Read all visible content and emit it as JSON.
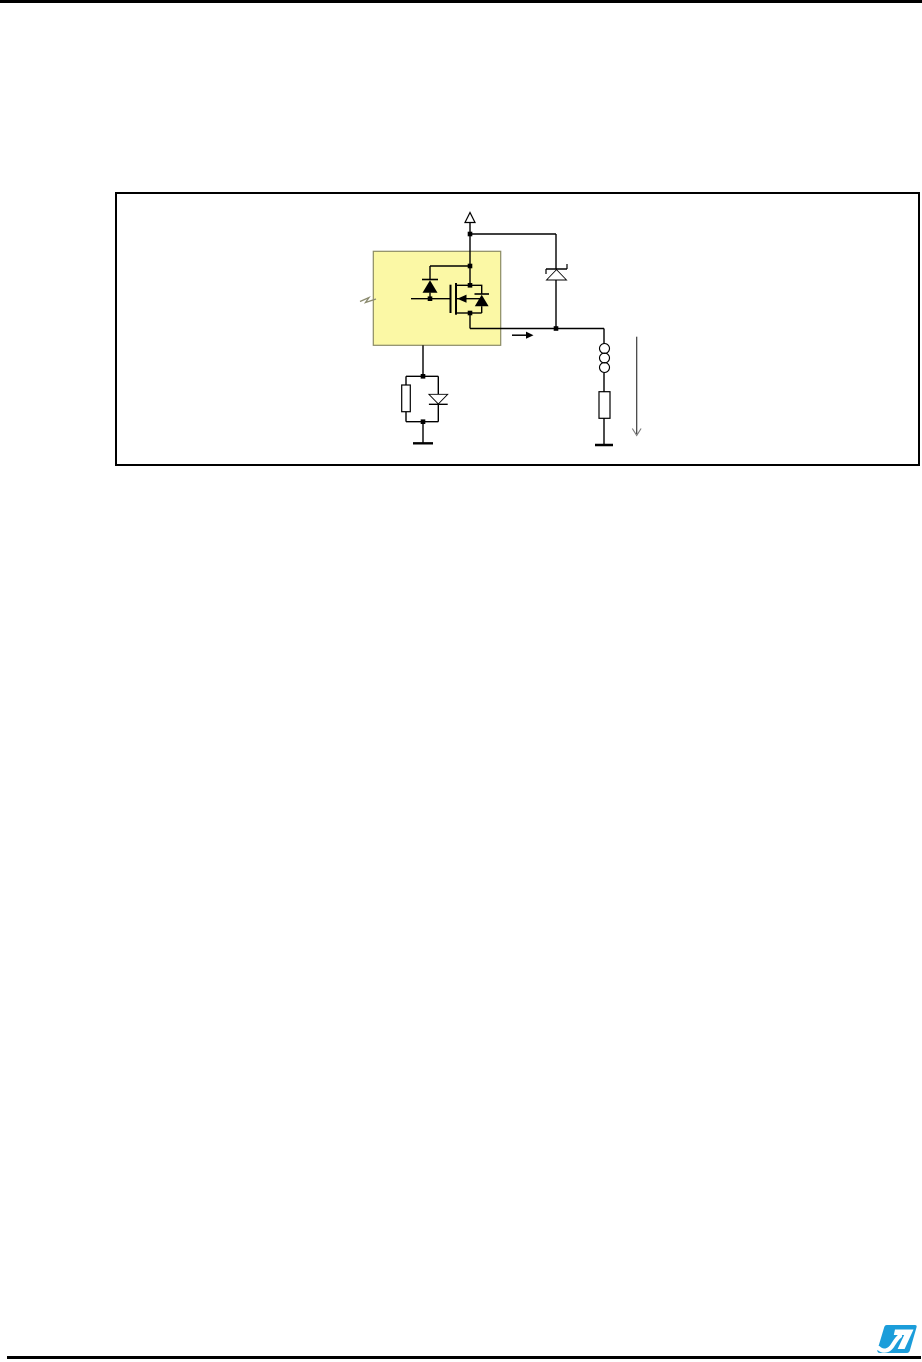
{
  "page": {
    "background_color": "#ffffff",
    "top_rule_color": "#000000",
    "bottom_rule_color": "#000000"
  },
  "figure": {
    "kind": "circuit-schematic",
    "frame_color": "#000000",
    "wire_color": "#000000",
    "highlight_block": {
      "fill": "#FBF8A5",
      "stroke": "#8B8B66"
    },
    "components": {
      "supply_arrow": "supply-rail-arrow",
      "clamp_zener": "zener-diode",
      "gate_diode": "gate-protection-diode",
      "mosfet": "n-channel-mosfet",
      "body_diode": "mosfet-body-diode",
      "input_break": "input-zigzag-break",
      "output_arrow": "output-current-arrow",
      "gate_resistor": "gate-source-resistor",
      "gate_diode_lower": "gate-source-diode",
      "load_inductor": "load-inductor",
      "load_resistor": "load-resistor",
      "load_arrow": "load-current-arrow",
      "ground_left": "ground-symbol-left",
      "ground_right": "ground-symbol-right"
    }
  },
  "footer": {
    "logo": {
      "name": "st-logo",
      "monogram": "ST",
      "color": "#1B9DDA"
    }
  }
}
